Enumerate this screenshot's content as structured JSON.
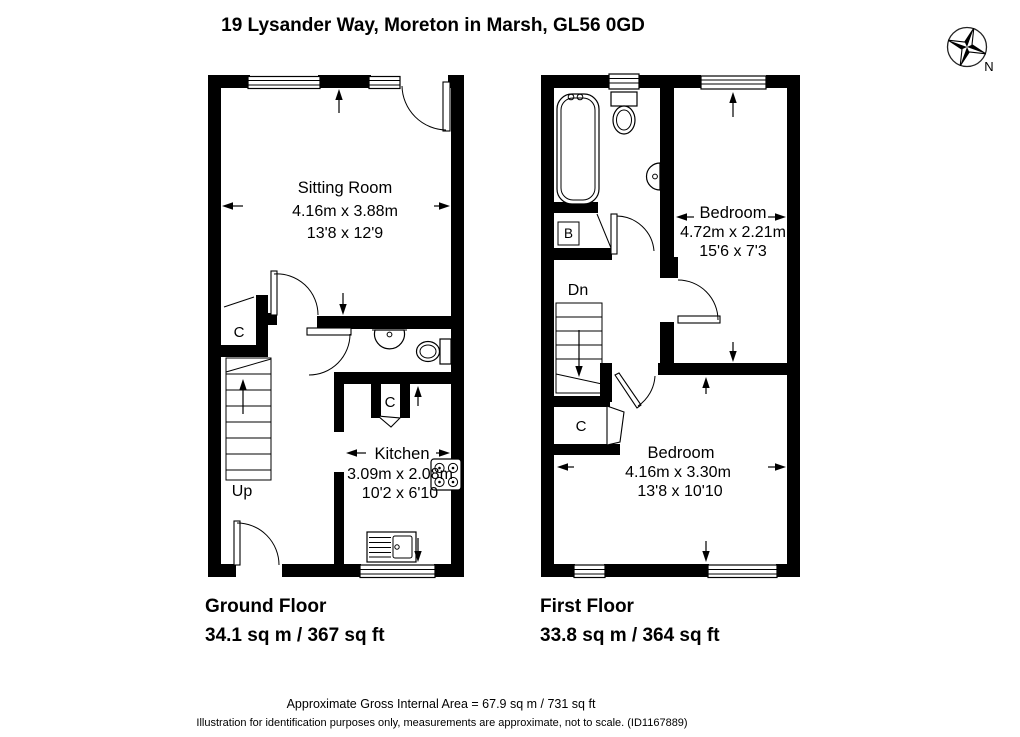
{
  "title": "19 Lysander Way, Moreton in Marsh, GL56 0GD",
  "compass": {
    "north_label": "N"
  },
  "ground_floor": {
    "caption": "Ground Floor",
    "area": "34.1 sq m / 367 sq ft",
    "sitting_room": {
      "name": "Sitting Room",
      "metric": "4.16m x 3.88m",
      "imperial": "13'8 x 12'9"
    },
    "kitchen": {
      "name": "Kitchen",
      "metric": "3.09m x 2.08m",
      "imperial": "10'2 x 6'10"
    },
    "cupboard_label": "C",
    "kitchen_cupboard_label": "C",
    "stairs_label": "Up"
  },
  "first_floor": {
    "caption": "First Floor",
    "area": "33.8 sq m / 364 sq ft",
    "bedroom1": {
      "name": "Bedroom",
      "metric": "4.72m x 2.21m",
      "imperial": "15'6 x 7'3"
    },
    "bedroom2": {
      "name": "Bedroom",
      "metric": "4.16m x 3.30m",
      "imperial": "13'8 x 10'10"
    },
    "boiler_label": "B",
    "cupboard_label": "C",
    "stairs_label": "Dn"
  },
  "footer": {
    "gross_area": "Approximate Gross Internal Area = 67.9 sq m / 731 sq ft",
    "disclaimer": "Illustration for identification purposes only, measurements are approximate, not to scale. (ID1167889)"
  },
  "colors": {
    "wall": "#000000",
    "background": "#ffffff",
    "text": "#000000"
  }
}
